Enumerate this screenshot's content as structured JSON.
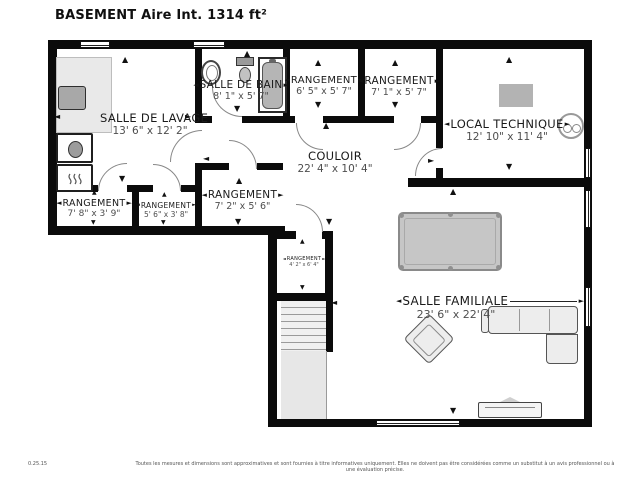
{
  "header": {
    "title": "BASEMENT Aire Int. 1314 ft²"
  },
  "icons": {
    "up": "▲",
    "down": "▼",
    "left": "◄",
    "right": "►"
  },
  "rooms": {
    "lavage": {
      "name": "SALLE DE LAVAGE",
      "dims": "13' 6\" x 12' 2\""
    },
    "bain": {
      "name": "SALLE DE BAIN",
      "dims": "8' 1\" x 5' 7\""
    },
    "rangement1": {
      "name": "RANGEMENT",
      "dims": "6' 5\" x 5' 7\""
    },
    "rangement2": {
      "name": "RANGEMENT",
      "dims": "7' 1\" x 5' 7\""
    },
    "local_technique": {
      "name": "LOCAL TECHNIQUE",
      "dims": "12' 10\" x 11' 4\""
    },
    "couloir": {
      "name": "COULOIR",
      "dims": "22' 4\" x 10' 4\""
    },
    "rangement3": {
      "name": "RANGEMENT",
      "dims": "7' 8\" x 3' 9\""
    },
    "rangement4": {
      "name": "RANGEMENT",
      "dims": "5' 6\" x 3' 8\""
    },
    "rangement5": {
      "name": "RANGEMENT",
      "dims": "7' 2\" x 5' 6\""
    },
    "rangement6": {
      "name": "RANGEMENT",
      "dims": "4' 2\" x 6' 4\""
    },
    "familiale": {
      "name": "SALLE FAMILIALE",
      "dims": "23' 6\" x 22' 4\""
    }
  },
  "footer": {
    "version": "0.25.15",
    "disclaimer": "Toutes les mesures et dimensions sont approximatives et sont fournies à titre informatives uniquement. Elles ne doivent pas être considérées comme un substitut à un avis professionnel ou à une évaluation précise."
  },
  "colors": {
    "wall": "#0b0b0b",
    "floor": "#ffffff",
    "furniture_gray": "#c6c6c6"
  }
}
